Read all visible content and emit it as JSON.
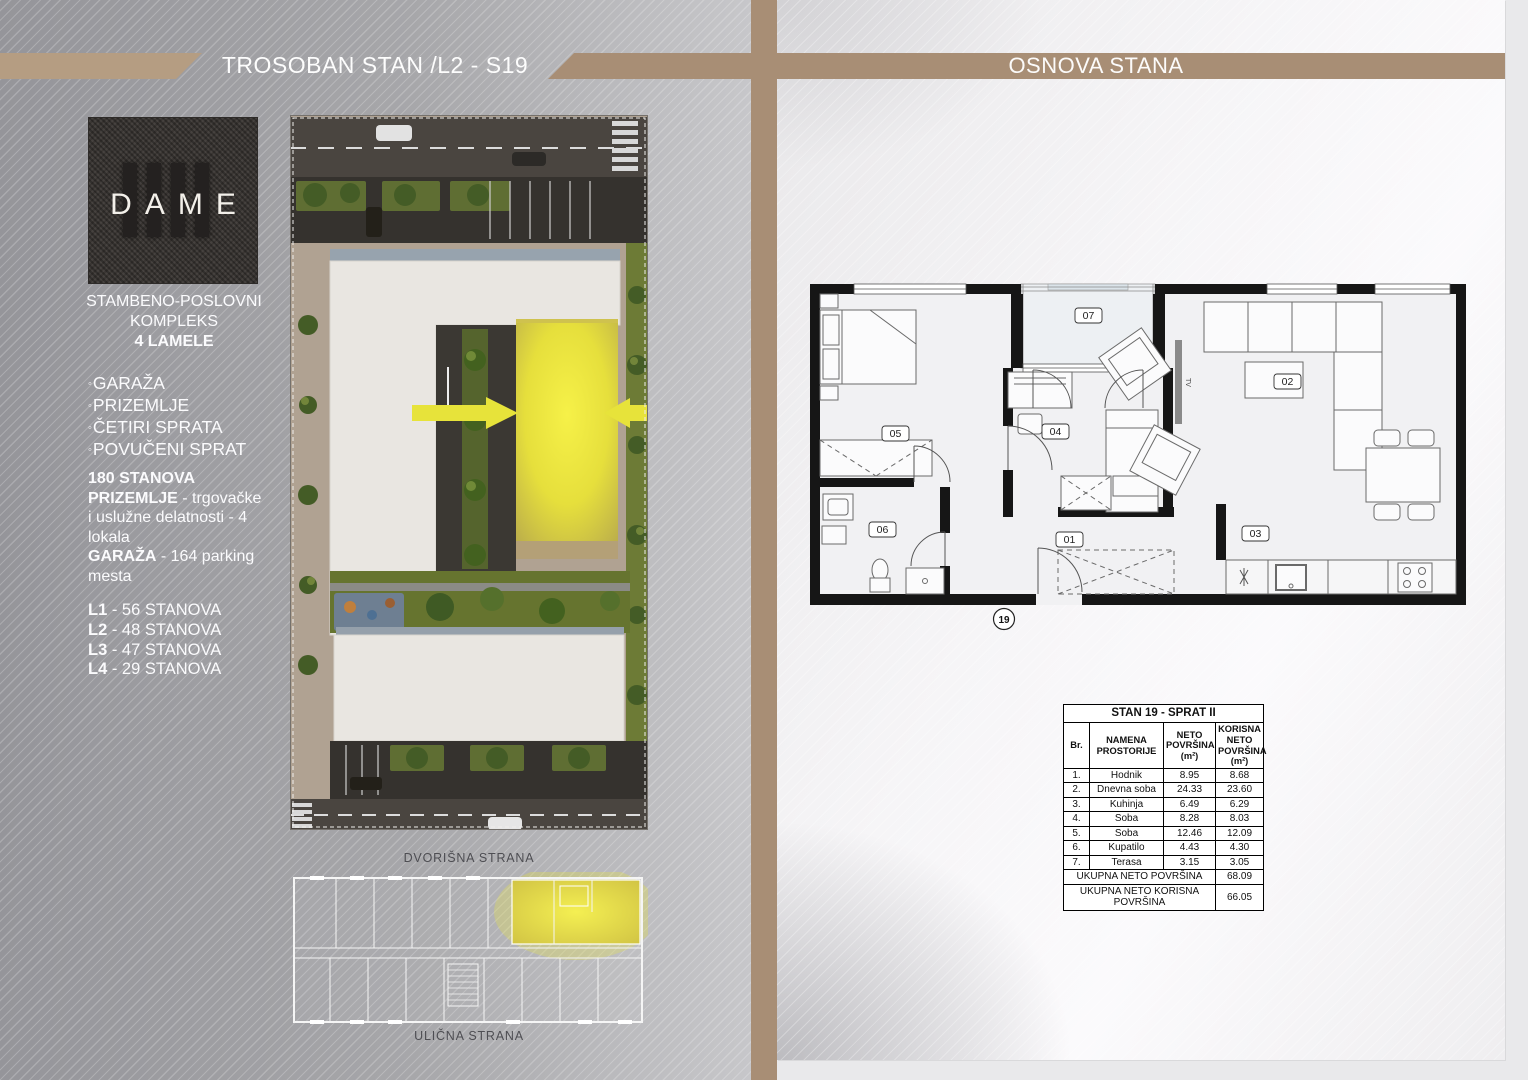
{
  "left": {
    "title": "TROSOBAN STAN /L2 - S19",
    "logo_text": "DAME",
    "bullet": "◦",
    "about_lines": [
      "STAMBENO-POSLOVNI",
      "KOMPLEKS",
      "4 LAMELE"
    ],
    "features": [
      "GARAŽA",
      "PRIZEMLJE",
      "ČETIRI SPRATA",
      "POVUČENI SPRAT"
    ],
    "info_lines": [
      {
        "b": "180 STANOVA",
        "r": ""
      },
      {
        "b": "PRIZEMLJE",
        "r": " - trgovačke i uslužne delatnosti - 4 lokala"
      },
      {
        "b": "GARAŽA",
        "r": " - 164 parking mesta"
      }
    ],
    "lamele": [
      {
        "b": "L1",
        "r": " - 56 STANOVA"
      },
      {
        "b": "L2",
        "r": " - 48 STANOVA"
      },
      {
        "b": "L3",
        "r": " - 47 STANOVA"
      },
      {
        "b": "L4",
        "r": " - 29 STANOVA"
      }
    ],
    "captions": {
      "top": "DVORIŠNA STRANA",
      "bottom": "ULIČNA STRANA"
    }
  },
  "right": {
    "title": "OSNOVA STANA",
    "plan": {
      "rooms": {
        "r01": "01",
        "r02": "02",
        "r03": "03",
        "r04": "04",
        "r05": "05",
        "r06": "06",
        "r07": "07"
      },
      "unit": "19",
      "tv": "TV"
    },
    "table": {
      "title": "STAN 19 - SPRAT II",
      "headers": [
        "Br.",
        "NAMENA PROSTORIJE",
        "NETO POVRŠINA (m²)",
        "KORISNA NETO POVRŠINA (m²)"
      ],
      "rows": [
        {
          "br": "1.",
          "name": "Hodnik",
          "neto": "8.95",
          "korisna": "8.68"
        },
        {
          "br": "2.",
          "name": "Dnevna soba",
          "neto": "24.33",
          "korisna": "23.60"
        },
        {
          "br": "3.",
          "name": "Kuhinja",
          "neto": "6.49",
          "korisna": "6.29"
        },
        {
          "br": "4.",
          "name": "Soba",
          "neto": "8.28",
          "korisna": "8.03"
        },
        {
          "br": "5.",
          "name": "Soba",
          "neto": "12.46",
          "korisna": "12.09"
        },
        {
          "br": "6.",
          "name": "Kupatilo",
          "neto": "4.43",
          "korisna": "4.30"
        },
        {
          "br": "7.",
          "name": "Terasa",
          "neto": "3.15",
          "korisna": "3.05"
        }
      ],
      "total_neto_label": "UKUPNA NETO POVRŠINA",
      "total_neto": "68.09",
      "total_korisna_label": "UKUPNA NETO KORISNA POVRŠINA",
      "total_korisna": "66.05"
    }
  },
  "colors": {
    "band_tan": "#a88e75",
    "highlight_yellow": "#e9e53c",
    "left_gray": "#9c9ca0",
    "panel_white": "#f5f4f6"
  }
}
